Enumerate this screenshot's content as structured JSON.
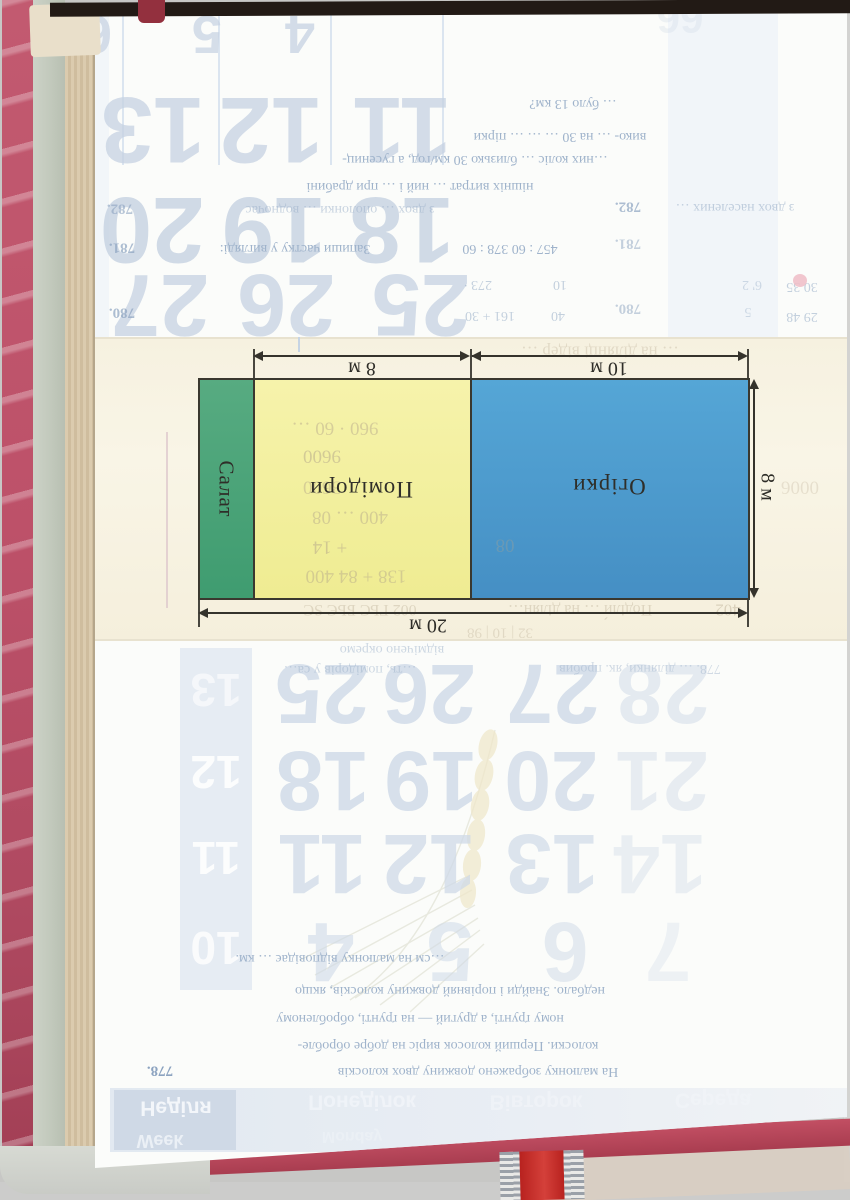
{
  "scene": "scanned schoolbook page rotated 180 degrees, plot diagram visible through cut-out window",
  "diagram": {
    "labels": {
      "salat": "Салат",
      "tomato": "Помідори",
      "cucumber": "Огірки"
    },
    "dims": {
      "top_yellow": "8 м",
      "top_blue": "10 м",
      "right": "8 м",
      "bottom": "20 м"
    },
    "dimensions_m": {
      "total_width": 20,
      "height": 8,
      "tomato_width": 8,
      "cucumber_width": 10
    },
    "colors": {
      "green": "#4ea377",
      "yellow": "#f3efa0",
      "blue": "#4c9ecf",
      "line": "#3a382f",
      "cream_band": "#f8f3e3"
    }
  },
  "ghosts": {
    "top_numbers": [
      {
        "t": "6",
        "x": 97,
        "y": 34,
        "s": 54,
        "o": 0.7
      },
      {
        "t": "5",
        "x": 207,
        "y": 34,
        "s": 54,
        "o": 0.7
      },
      {
        "t": "4",
        "x": 300,
        "y": 34,
        "s": 54,
        "o": 0.75
      },
      {
        "t": "66",
        "x": 680,
        "y": 18,
        "s": 42,
        "o": 0.25
      },
      {
        "t": "13",
        "x": 153,
        "y": 130,
        "s": 94,
        "o": 0.75
      },
      {
        "t": "12",
        "x": 271,
        "y": 130,
        "s": 94,
        "o": 0.75
      },
      {
        "t": "11",
        "x": 402,
        "y": 130,
        "s": 94,
        "o": 0.75
      },
      {
        "t": "20",
        "x": 152,
        "y": 230,
        "s": 94,
        "o": 0.8
      },
      {
        "t": "19",
        "x": 274,
        "y": 230,
        "s": 94,
        "o": 0.8
      },
      {
        "t": "18",
        "x": 402,
        "y": 230,
        "s": 94,
        "o": 0.8
      },
      {
        "t": "27",
        "x": 160,
        "y": 305,
        "s": 88,
        "o": 0.75
      },
      {
        "t": "26",
        "x": 286,
        "y": 305,
        "s": 88,
        "o": 0.75
      },
      {
        "t": "25",
        "x": 421,
        "y": 305,
        "s": 88,
        "o": 0.75
      }
    ],
    "top_texts": [
      {
        "t": "… було 13 км?",
        "x": 573,
        "y": 103
      },
      {
        "t": "вико- … на 30 … … … пірки",
        "x": 560,
        "y": 136
      },
      {
        "t": "…них коліс … близько 30 км/год, а гусениц-",
        "x": 475,
        "y": 159
      },
      {
        "t": "нішніх витрат … ний і … при драбині",
        "x": 420,
        "y": 186
      },
      {
        "t": "782.",
        "x": 120,
        "y": 208,
        "b": 1,
        "o": 0.6
      },
      {
        "t": "з двох … ополонки … водночас",
        "x": 340,
        "y": 209,
        "o": 0.55
      },
      {
        "t": "782.",
        "x": 628,
        "y": 206,
        "b": 1,
        "o": 0.7
      },
      {
        "t": "з двох населених …",
        "x": 735,
        "y": 207,
        "o": 0.6
      },
      {
        "t": "781.",
        "x": 122,
        "y": 247,
        "b": 1,
        "o": 0.7
      },
      {
        "t": "Запиши частку у вигляді:",
        "x": 295,
        "y": 248
      },
      {
        "t": "457 : 60   378 : 60",
        "x": 510,
        "y": 248
      },
      {
        "t": "781.",
        "x": 628,
        "y": 243,
        "b": 1,
        "o": 0.5
      },
      {
        "t": "273 ∙",
        "x": 478,
        "y": 284,
        "o": 0.6
      },
      {
        "t": "10",
        "x": 560,
        "y": 284,
        "o": 0.6
      },
      {
        "t": "6' 2",
        "x": 752,
        "y": 284,
        "o": 0.45
      },
      {
        "t": "30  35",
        "x": 802,
        "y": 286,
        "o": 0.6
      },
      {
        "t": "780.",
        "x": 122,
        "y": 312,
        "b": 1,
        "o": 0.7
      },
      {
        "t": "161 + 30",
        "x": 490,
        "y": 315,
        "o": 0.6
      },
      {
        "t": "40",
        "x": 558,
        "y": 315,
        "o": 0.6
      },
      {
        "t": "780.",
        "x": 628,
        "y": 308,
        "b": 1,
        "o": 0.5
      },
      {
        "t": "5",
        "x": 748,
        "y": 311,
        "o": 0.45
      },
      {
        "t": "29  48",
        "x": 802,
        "y": 316,
        "o": 0.6
      }
    ],
    "bottom_numbers": [
      {
        "t": "25",
        "x": 322,
        "y": 694,
        "s": 84,
        "o": 0.8
      },
      {
        "t": "26",
        "x": 429,
        "y": 694,
        "s": 84,
        "o": 0.8
      },
      {
        "t": "27",
        "x": 553,
        "y": 694,
        "s": 84,
        "o": 0.8
      },
      {
        "t": "28",
        "x": 663,
        "y": 694,
        "s": 84,
        "o": 0.5
      },
      {
        "t": "18",
        "x": 323,
        "y": 781,
        "s": 84,
        "o": 0.8
      },
      {
        "t": "19",
        "x": 431,
        "y": 781,
        "s": 84,
        "o": 0.8
      },
      {
        "t": "20",
        "x": 551,
        "y": 781,
        "s": 84,
        "o": 0.75
      },
      {
        "t": "21",
        "x": 662,
        "y": 781,
        "s": 84,
        "o": 0.45
      },
      {
        "t": "11",
        "x": 322,
        "y": 864,
        "s": 84,
        "o": 0.75
      },
      {
        "t": "12",
        "x": 429,
        "y": 864,
        "s": 84,
        "o": 0.75
      },
      {
        "t": "13",
        "x": 552,
        "y": 864,
        "s": 84,
        "o": 0.7
      },
      {
        "t": "14",
        "x": 660,
        "y": 864,
        "s": 84,
        "o": 0.4
      },
      {
        "t": "4",
        "x": 331,
        "y": 952,
        "s": 84,
        "o": 0.6
      },
      {
        "t": "5",
        "x": 450,
        "y": 952,
        "s": 84,
        "o": 0.55
      },
      {
        "t": "6",
        "x": 565,
        "y": 952,
        "s": 84,
        "o": 0.5
      },
      {
        "t": "7",
        "x": 668,
        "y": 952,
        "s": 84,
        "o": 0.3
      }
    ],
    "box_numbers": [
      {
        "t": "13",
        "x": 216,
        "y": 690,
        "s": 46,
        "o": 0.6
      },
      {
        "t": "12",
        "x": 216,
        "y": 772,
        "s": 46,
        "o": 0.9
      },
      {
        "t": "11",
        "x": 216,
        "y": 858,
        "s": 46,
        "o": 0.9
      },
      {
        "t": "10",
        "x": 216,
        "y": 948,
        "s": 46,
        "o": 0.8
      }
    ],
    "bottom_texts": [
      {
        "t": "відмічено окремо",
        "x": 392,
        "y": 649,
        "o": 0.5
      },
      {
        "t": "…ть, помідорів у са…",
        "x": 350,
        "y": 669,
        "o": 0.5
      },
      {
        "t": "778. … ділянки, як. пробив",
        "x": 640,
        "y": 668,
        "o": 0.45
      },
      {
        "t": "…см на малюнку відповідає … км.",
        "x": 340,
        "y": 958
      },
      {
        "t": "недбало. Знайди і порівняй довжину колосків, якщо",
        "x": 450,
        "y": 990
      },
      {
        "t": "ному ґрунті, а другий — на ґрунті, обробленому",
        "x": 420,
        "y": 1018
      },
      {
        "t": "колоски. Перший колосок виріс на добре обробле-",
        "x": 448,
        "y": 1045
      },
      {
        "t": "778.",
        "x": 160,
        "y": 1070,
        "b": 1
      },
      {
        "t": "На малюнку зображено довжину двох колосків",
        "x": 478,
        "y": 1071
      }
    ],
    "cream_texts": [
      {
        "t": "… на ділянці відер …",
        "x": 600,
        "y": 352,
        "o": 0.3,
        "s": 17
      },
      {
        "t": "002 ГЬС БЬЄ ЅС",
        "x": 360,
        "y": 609,
        "o": 0.35,
        "s": 16
      },
      {
        "t": "Поділи́ … на ділян…",
        "x": 580,
        "y": 609,
        "o": 0.35,
        "s": 16
      },
      {
        "t": "402",
        "x": 728,
        "y": 610,
        "o": 0.4,
        "s": 17
      },
      {
        "t": "32 | 10 | 98",
        "x": 500,
        "y": 632,
        "o": 0.3,
        "s": 15
      },
      {
        "t": "0006",
        "x": 800,
        "y": 487,
        "o": 0.25,
        "s": 19
      }
    ],
    "yellow_texts": [
      {
        "t": "960 · 60 …",
        "x": 335,
        "y": 428,
        "o": 0.45
      },
      {
        "t": "9600",
        "x": 322,
        "y": 456,
        "o": 0.5
      },
      {
        "t": "3600",
        "x": 322,
        "y": 487,
        "o": 0.45
      },
      {
        "t": "400 … 08",
        "x": 350,
        "y": 517,
        "o": 0.45
      },
      {
        "t": "+ 14",
        "x": 330,
        "y": 547,
        "o": 0.5
      },
      {
        "t": "138 + 84   400",
        "x": 356,
        "y": 576,
        "o": 0.45
      },
      {
        "t": "08",
        "x": 505,
        "y": 545,
        "o": 0.3
      }
    ],
    "day_labels": [
      {
        "t": "Неділя",
        "x": 176,
        "y": 1108,
        "s": 21,
        "o": 1
      },
      {
        "t": "Week",
        "x": 160,
        "y": 1141,
        "s": 18,
        "o": 0.8
      },
      {
        "t": "Понеділок",
        "x": 362,
        "y": 1102,
        "s": 21,
        "o": 0.75
      },
      {
        "t": "Monday",
        "x": 352,
        "y": 1136,
        "s": 16,
        "o": 0.4
      },
      {
        "t": "Вівторок",
        "x": 536,
        "y": 1102,
        "s": 21,
        "o": 0.6
      },
      {
        "t": "Середа",
        "x": 713,
        "y": 1100,
        "s": 21,
        "o": 0.55
      }
    ]
  }
}
